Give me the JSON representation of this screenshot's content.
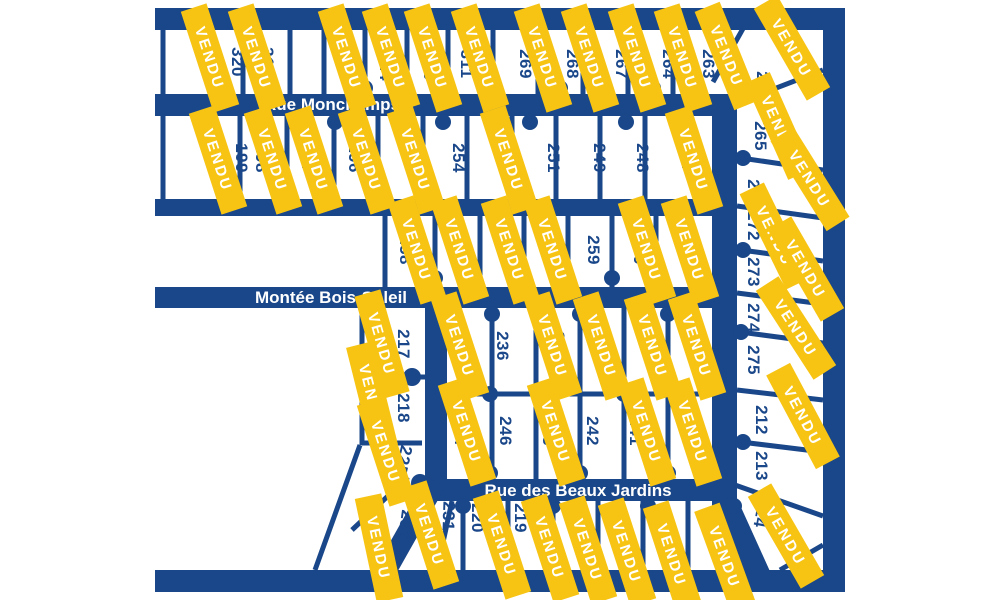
{
  "map": {
    "title": "plan-des-lots",
    "sold_label": "VENDU",
    "colors": {
      "navy": "#1a4789",
      "yellow": "#f7c414",
      "white": "#ffffff",
      "background": "#ffffff"
    },
    "streets": [
      {
        "name": "Rue Monchamps"
      },
      {
        "name": "Montée Bois-Soleil"
      },
      {
        "name": "Rue des Beaux Jardins"
      }
    ],
    "lots": [
      {
        "label": "320",
        "x": 232,
        "y": 62
      },
      {
        "label": "317",
        "x": 262,
        "y": 62
      },
      {
        "label": "315",
        "x": 340,
        "y": 66
      },
      {
        "label": "314",
        "x": 380,
        "y": 66
      },
      {
        "label": "310",
        "x": 424,
        "y": 66
      },
      {
        "label": "311",
        "x": 461,
        "y": 64
      },
      {
        "label": "269",
        "x": 520,
        "y": 64
      },
      {
        "label": "268",
        "x": 567,
        "y": 64
      },
      {
        "label": "267",
        "x": 616,
        "y": 64
      },
      {
        "label": "264",
        "x": 663,
        "y": 64
      },
      {
        "label": "263",
        "x": 703,
        "y": 64
      },
      {
        "label": "199",
        "x": 236,
        "y": 158
      },
      {
        "label": "198",
        "x": 256,
        "y": 158
      },
      {
        "label": "197",
        "x": 302,
        "y": 158
      },
      {
        "label": "196",
        "x": 349,
        "y": 158
      },
      {
        "label": "255",
        "x": 408,
        "y": 158
      },
      {
        "label": "254",
        "x": 453,
        "y": 158
      },
      {
        "label": "253",
        "x": 501,
        "y": 158
      },
      {
        "label": "251",
        "x": 548,
        "y": 158
      },
      {
        "label": "249",
        "x": 594,
        "y": 158
      },
      {
        "label": "248",
        "x": 637,
        "y": 158
      },
      {
        "label": "247",
        "x": 682,
        "y": 158
      },
      {
        "label": "258",
        "x": 400,
        "y": 250
      },
      {
        "label": "257",
        "x": 455,
        "y": 250
      },
      {
        "label": "261",
        "x": 502,
        "y": 250
      },
      {
        "label": "260",
        "x": 546,
        "y": 250
      },
      {
        "label": "259",
        "x": 588,
        "y": 250
      },
      {
        "label": "250",
        "x": 634,
        "y": 250
      },
      {
        "label": "252",
        "x": 684,
        "y": 250
      },
      {
        "label": "262",
        "x": 757,
        "y": 86
      },
      {
        "label": "265",
        "x": 755,
        "y": 136
      },
      {
        "label": "266",
        "x": 748,
        "y": 194
      },
      {
        "label": "272",
        "x": 748,
        "y": 226
      },
      {
        "label": "273",
        "x": 748,
        "y": 272
      },
      {
        "label": "274",
        "x": 748,
        "y": 318
      },
      {
        "label": "275",
        "x": 748,
        "y": 360
      },
      {
        "label": "212",
        "x": 756,
        "y": 420
      },
      {
        "label": "213",
        "x": 756,
        "y": 466
      },
      {
        "label": "214",
        "x": 756,
        "y": 512,
        "r": 100
      },
      {
        "label": "215",
        "x": 710,
        "y": 521,
        "r": 94
      },
      {
        "label": "217",
        "x": 398,
        "y": 344
      },
      {
        "label": "218",
        "x": 398,
        "y": 408
      },
      {
        "label": "225",
        "x": 398,
        "y": 459,
        "r": 103
      },
      {
        "label": "232",
        "x": 400,
        "y": 524,
        "r": 98
      },
      {
        "label": "231",
        "x": 443,
        "y": 516,
        "r": 92
      },
      {
        "label": "236",
        "x": 497,
        "y": 346
      },
      {
        "label": "235",
        "x": 553,
        "y": 346
      },
      {
        "label": "240",
        "x": 600,
        "y": 346
      },
      {
        "label": "238",
        "x": 645,
        "y": 346
      },
      {
        "label": "237",
        "x": 687,
        "y": 346
      },
      {
        "label": "244",
        "x": 455,
        "y": 431
      },
      {
        "label": "246",
        "x": 500,
        "y": 431
      },
      {
        "label": "243",
        "x": 543,
        "y": 431
      },
      {
        "label": "242",
        "x": 587,
        "y": 431
      },
      {
        "label": "241",
        "x": 630,
        "y": 431
      },
      {
        "label": "239",
        "x": 682,
        "y": 431
      },
      {
        "label": "220",
        "x": 472,
        "y": 518
      },
      {
        "label": "219",
        "x": 515,
        "y": 518
      }
    ],
    "banners": [
      {
        "x": 210,
        "y": 58,
        "r": 72
      },
      {
        "x": 257,
        "y": 58,
        "r": 72
      },
      {
        "x": 347,
        "y": 58,
        "r": 72
      },
      {
        "x": 391,
        "y": 58,
        "r": 72
      },
      {
        "x": 433,
        "y": 58,
        "r": 72
      },
      {
        "x": 480,
        "y": 58,
        "r": 72
      },
      {
        "x": 543,
        "y": 58,
        "r": 72
      },
      {
        "x": 590,
        "y": 58,
        "r": 72
      },
      {
        "x": 637,
        "y": 58,
        "r": 72
      },
      {
        "x": 683,
        "y": 58,
        "r": 72
      },
      {
        "x": 727,
        "y": 56,
        "r": 68
      },
      {
        "x": 218,
        "y": 160,
        "r": 72
      },
      {
        "x": 273,
        "y": 160,
        "r": 72
      },
      {
        "x": 314,
        "y": 160,
        "r": 72
      },
      {
        "x": 367,
        "y": 160,
        "r": 72
      },
      {
        "x": 416,
        "y": 160,
        "r": 72
      },
      {
        "x": 509,
        "y": 160,
        "r": 72
      },
      {
        "x": 694,
        "y": 160,
        "r": 72
      },
      {
        "x": 417,
        "y": 250,
        "r": 72
      },
      {
        "x": 460,
        "y": 250,
        "r": 72
      },
      {
        "x": 510,
        "y": 250,
        "r": 72
      },
      {
        "x": 553,
        "y": 250,
        "r": 72
      },
      {
        "x": 647,
        "y": 250,
        "r": 72
      },
      {
        "x": 690,
        "y": 250,
        "r": 72
      },
      {
        "x": 382,
        "y": 344,
        "r": 74
      },
      {
        "x": 460,
        "y": 346,
        "r": 72
      },
      {
        "x": 553,
        "y": 346,
        "r": 72
      },
      {
        "x": 602,
        "y": 346,
        "r": 72
      },
      {
        "x": 653,
        "y": 346,
        "r": 72
      },
      {
        "x": 697,
        "y": 346,
        "r": 72
      },
      {
        "x": 372,
        "y": 396,
        "r": 76
      },
      {
        "x": 386,
        "y": 452,
        "r": 72
      },
      {
        "x": 379,
        "y": 548,
        "r": 78
      },
      {
        "x": 430,
        "y": 535,
        "r": 72
      },
      {
        "x": 467,
        "y": 432,
        "r": 72
      },
      {
        "x": 556,
        "y": 432,
        "r": 72
      },
      {
        "x": 647,
        "y": 432,
        "r": 72
      },
      {
        "x": 693,
        "y": 432,
        "r": 72
      },
      {
        "x": 502,
        "y": 545,
        "r": 72
      },
      {
        "x": 550,
        "y": 548,
        "r": 72
      },
      {
        "x": 588,
        "y": 550,
        "r": 72
      },
      {
        "x": 627,
        "y": 552,
        "r": 72
      },
      {
        "x": 672,
        "y": 555,
        "r": 72
      },
      {
        "x": 725,
        "y": 557,
        "r": 70
      },
      {
        "x": 792,
        "y": 48,
        "r": 60
      },
      {
        "x": 779,
        "y": 126,
        "r": 66
      },
      {
        "x": 810,
        "y": 179,
        "r": 58
      },
      {
        "x": 775,
        "y": 236,
        "r": 64
      },
      {
        "x": 806,
        "y": 269,
        "r": 60
      },
      {
        "x": 796,
        "y": 328,
        "r": 57
      },
      {
        "x": 803,
        "y": 416,
        "r": 62
      },
      {
        "x": 786,
        "y": 536,
        "r": 60
      }
    ]
  }
}
